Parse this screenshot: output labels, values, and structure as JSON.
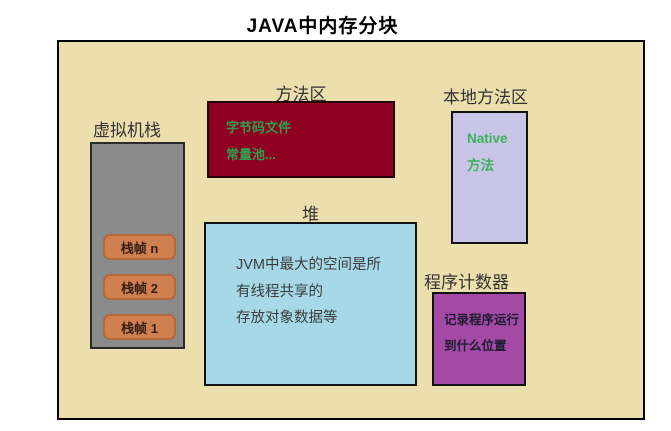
{
  "title": "JAVA中内存分块",
  "colors": {
    "canvas_bg": "#ecdfad",
    "vm_stack_fill": "#8b8b8b",
    "stack_frame_fill": "#d07f4f",
    "method_area_fill": "#8e0121",
    "method_area_text_green": "#2f9e4e",
    "heap_fill": "#a6d8e8",
    "native_area_fill": "#c9c5e6",
    "native_area_text_green": "#3bb25d",
    "program_counter_fill": "#a44aa6"
  },
  "regions": {
    "vm_stack": {
      "label": "虚拟机栈",
      "frames": [
        "栈帧 n",
        "栈帧 2",
        "栈帧 1"
      ]
    },
    "method_area": {
      "label": "方法区",
      "lines": [
        "字节码文件",
        "常量池..."
      ]
    },
    "heap": {
      "label": "堆",
      "lines": [
        "JVM中最大的空间是所",
        "有线程共享的",
        "存放对象数据等"
      ]
    },
    "native_area": {
      "label": "本地方法区",
      "lines": [
        "Native",
        "方法"
      ]
    },
    "program_counter": {
      "label": "程序计数器",
      "lines": [
        "记录程序运行",
        "到什么位置"
      ]
    }
  }
}
